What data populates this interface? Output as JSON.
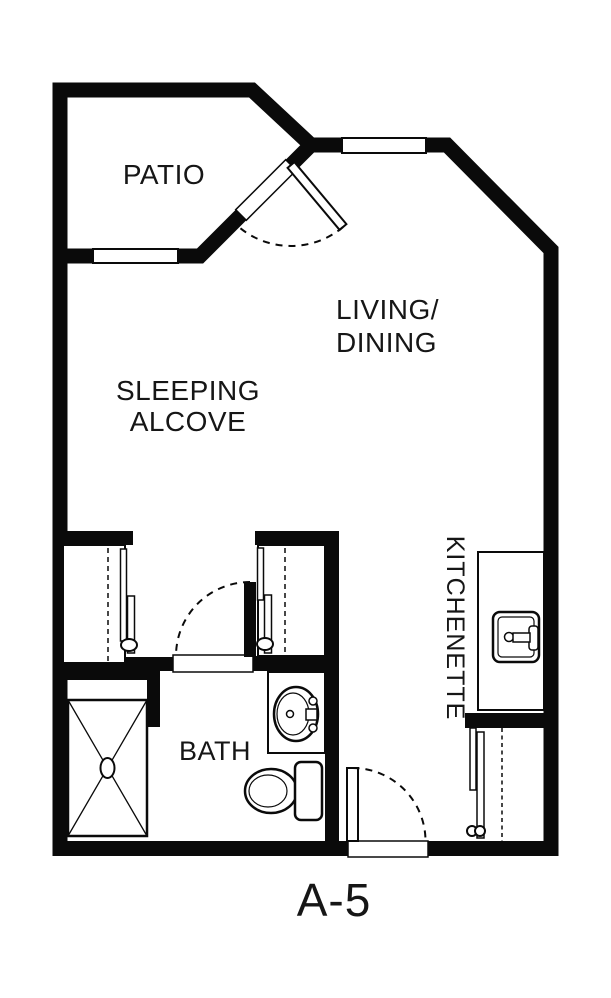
{
  "page": {
    "background_color": "#ffffff",
    "ink_color": "#0a0a0a"
  },
  "floor_plan": {
    "unit_label": "A-5",
    "room_labels": {
      "patio": "PATIO",
      "living_dining_line1": "LIVING/",
      "living_dining_line2": "DINING",
      "sleeping_alcove_line1": "SLEEPING",
      "sleeping_alcove_line2": "ALCOVE",
      "bath": "BATH",
      "kitchenette": "KITCHENETTE"
    }
  }
}
